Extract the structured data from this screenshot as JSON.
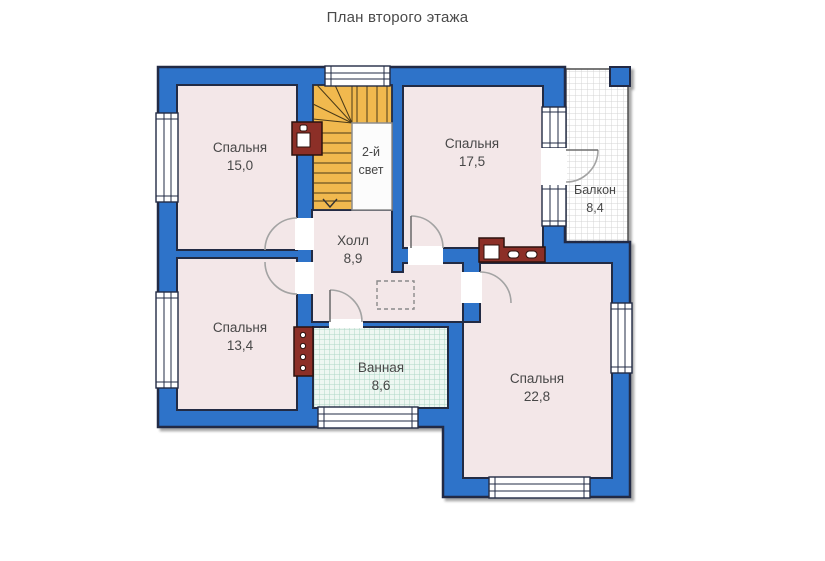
{
  "title": "План второго этажа",
  "rooms": {
    "bedroom_top_left": {
      "name": "Спальня",
      "area": "15,0"
    },
    "bedroom_top_right": {
      "name": "Спальня",
      "area": "17,5"
    },
    "bedroom_bottom_left": {
      "name": "Спальня",
      "area": "13,4"
    },
    "bedroom_bottom_right": {
      "name": "Спальня",
      "area": "22,8"
    },
    "hall": {
      "name": "Холл",
      "area": "8,9"
    },
    "bathroom": {
      "name": "Ванная",
      "area": "8,6"
    },
    "balcony": {
      "name": "Балкон",
      "area": "8,4"
    },
    "second_light": {
      "line1": "2-й",
      "line2": "свет"
    }
  },
  "colors": {
    "wall_blue": "#2d73c9",
    "outline_dark": "#222b44",
    "floor_pink": "#f3e7e8",
    "stairs_orange": "#f1b94e",
    "bathroom_tile": "#aed7c6",
    "balcony_grid": "#d4d4d4",
    "flue_red": "#8c2f27"
  }
}
